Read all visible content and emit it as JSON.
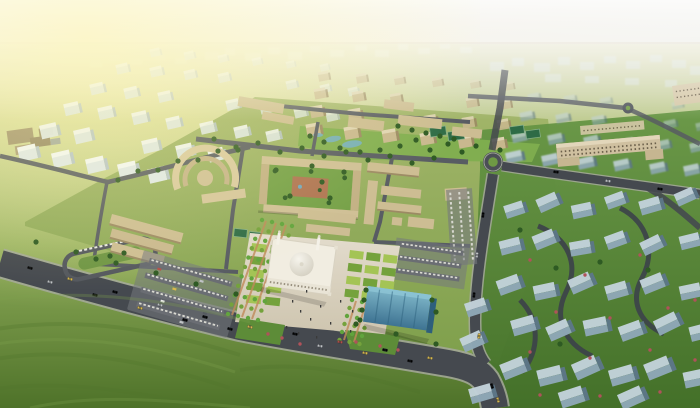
{
  "meta": {
    "description": "Sunlit aerial rendering of a master-planned district: tan low-rise campus around a central domed mosque and plaza, white apartment blocks fading into haze upper-left, beige residential towers top-center with a park, blue-gray housing clusters to the right, tree-lined boulevards with cars, open grassland in the foreground."
  },
  "palette": {
    "sky_top": "#d8d1bd",
    "sky_mid": "#ece6d6",
    "sky_low": "#f6f3e8",
    "sky_right": "#e0e8ec",
    "horizon": "#d9d2bd",
    "sun_glow": "#fbf3ac",
    "ground_haze": "#e3e2c8",
    "grass_light": "#becb90",
    "grass_mid": "#8fac5a",
    "grass_deep": "#4e7229",
    "road": "#45494f",
    "road_edge": "#a6a99c",
    "street": "#585c63",
    "inner_road": "#3c424a",
    "campus_green_1": "#a2b569",
    "campus_green_2": "#7fa04c",
    "tan_face": "#c9b88f",
    "tan_top": "#e0d5b4",
    "tan_shade": "#9c8a64",
    "beige_school": "#cfc0a0",
    "white_face": "#dfe8eb",
    "white_top": "#f3f7f8",
    "white_shade": "#b6c4cb",
    "blue_top": "#c2d2da",
    "blue_face": "#8fa8b7",
    "blue_shade": "#5d7788",
    "lawn_a": "#a4c455",
    "lawn_b": "#74a23c",
    "tree": "#2e5a23",
    "palm": "#61a43d",
    "bush_red": "#b0525a",
    "plaza_light": "#e3dccd",
    "plaza_dark": "#cec5af",
    "terracotta": "#ae7352",
    "walkway": "#c08a5a",
    "mosque_wall": "#f1ede1",
    "mosque_dome_hi": "#f6f4ec",
    "mosque_dome_lo": "#cfcabb",
    "glass_hi": "#7fb7c9",
    "glass_lo": "#3e7392",
    "pond": "#74aec2",
    "court_green": "#2e6b46",
    "parking": "#75787d",
    "car_white": "#ececе6",
    "car_yellow": "#d9b94c",
    "car_silver": "#c0c3c6",
    "car_red": "#b34f48",
    "car_dark": "#555a60"
  },
  "districts": {
    "white_blocks": [
      [
        18,
        152,
        1.3,
        1
      ],
      [
        52,
        158,
        1.3,
        1
      ],
      [
        86,
        164,
        1.3,
        1
      ],
      [
        118,
        169,
        1.3,
        1
      ],
      [
        148,
        174,
        1.25,
        1
      ],
      [
        40,
        130,
        1.2,
        0.95
      ],
      [
        74,
        135,
        1.2,
        0.95
      ],
      [
        142,
        145,
        1.15,
        0.95
      ],
      [
        176,
        150,
        1.15,
        0.95
      ],
      [
        208,
        154,
        1.1,
        0.95
      ],
      [
        64,
        108,
        1.05,
        0.9
      ],
      [
        98,
        112,
        1.05,
        0.9
      ],
      [
        132,
        117,
        1.05,
        0.9
      ],
      [
        166,
        122,
        1,
        0.9
      ],
      [
        200,
        127,
        1,
        0.9
      ],
      [
        234,
        131,
        1,
        0.9
      ],
      [
        266,
        135,
        0.95,
        0.88
      ],
      [
        90,
        88,
        0.95,
        0.8
      ],
      [
        124,
        92,
        0.95,
        0.8
      ],
      [
        158,
        96,
        0.9,
        0.8
      ],
      [
        226,
        104,
        0.9,
        0.78
      ],
      [
        260,
        108,
        0.85,
        0.76
      ],
      [
        294,
        112,
        0.85,
        0.75
      ],
      [
        326,
        116,
        0.8,
        0.72
      ],
      [
        116,
        68,
        0.85,
        0.62
      ],
      [
        150,
        71,
        0.85,
        0.62
      ],
      [
        184,
        74,
        0.8,
        0.6
      ],
      [
        218,
        77,
        0.8,
        0.58
      ],
      [
        286,
        84,
        0.75,
        0.55
      ],
      [
        320,
        88,
        0.7,
        0.5
      ],
      [
        348,
        91,
        0.7,
        0.48
      ],
      [
        150,
        52,
        0.7,
        0.45
      ],
      [
        184,
        55,
        0.7,
        0.42
      ],
      [
        218,
        58,
        0.65,
        0.4
      ],
      [
        252,
        61,
        0.65,
        0.38
      ],
      [
        286,
        64,
        0.6,
        0.35
      ],
      [
        320,
        67,
        0.6,
        0.32
      ]
    ],
    "beige_blocks": [
      [
        306,
        128,
        1.15,
        1
      ],
      [
        344,
        131,
        1.15,
        1
      ],
      [
        382,
        134,
        1.15,
        1
      ],
      [
        420,
        137,
        1.1,
        1
      ],
      [
        458,
        140,
        1.1,
        1
      ],
      [
        492,
        142,
        1.05,
        0.98
      ],
      [
        310,
        110,
        1.05,
        0.95
      ],
      [
        348,
        113,
        1.05,
        0.95
      ],
      [
        424,
        119,
        1,
        0.92
      ],
      [
        462,
        121,
        1,
        0.9
      ],
      [
        497,
        123,
        0.95,
        0.88
      ],
      [
        314,
        92,
        0.95,
        0.85
      ],
      [
        352,
        95,
        0.95,
        0.85
      ],
      [
        390,
        97,
        0.9,
        0.82
      ],
      [
        466,
        101,
        0.9,
        0.8
      ],
      [
        500,
        103,
        0.85,
        0.78
      ],
      [
        318,
        75,
        0.85,
        0.68
      ],
      [
        356,
        77,
        0.85,
        0.66
      ],
      [
        394,
        79,
        0.8,
        0.62
      ],
      [
        432,
        81,
        0.8,
        0.6
      ],
      [
        470,
        83,
        0.75,
        0.55
      ],
      [
        504,
        85,
        0.75,
        0.5
      ]
    ],
    "hazy_blue_blocks": [
      [
        506,
        158,
        1,
        0.92
      ],
      [
        542,
        161,
        1,
        0.9
      ],
      [
        578,
        164,
        1,
        0.9
      ],
      [
        614,
        166,
        0.95,
        0.88
      ],
      [
        650,
        169,
        0.95,
        0.85
      ],
      [
        684,
        171,
        0.95,
        0.85
      ],
      [
        512,
        138,
        0.9,
        0.75
      ],
      [
        548,
        140,
        0.9,
        0.75
      ],
      [
        584,
        142,
        0.9,
        0.72
      ],
      [
        620,
        144,
        0.85,
        0.7
      ],
      [
        656,
        146,
        0.85,
        0.7
      ],
      [
        690,
        148,
        0.85,
        0.68
      ],
      [
        520,
        117,
        0.8,
        0.6
      ],
      [
        556,
        119,
        0.8,
        0.58
      ],
      [
        592,
        121,
        0.78,
        0.55
      ],
      [
        664,
        125,
        0.75,
        0.52
      ],
      [
        696,
        127,
        0.72,
        0.5
      ],
      [
        528,
        98,
        0.7,
        0.42
      ],
      [
        564,
        100,
        0.7,
        0.4
      ],
      [
        600,
        102,
        0.68,
        0.38
      ],
      [
        672,
        106,
        0.65,
        0.35
      ]
    ],
    "blue_blocks": [
      [
        505,
        212,
        1.2,
        -18
      ],
      [
        538,
        206,
        1.3,
        -24
      ],
      [
        572,
        212,
        1.25,
        -12
      ],
      [
        606,
        203,
        1.2,
        -20
      ],
      [
        640,
        208,
        1.3,
        -16
      ],
      [
        676,
        200,
        1.2,
        -24
      ],
      [
        500,
        248,
        1.3,
        -14
      ],
      [
        534,
        243,
        1.35,
        -22
      ],
      [
        570,
        249,
        1.3,
        -10
      ],
      [
        606,
        243,
        1.25,
        -20
      ],
      [
        642,
        249,
        1.3,
        -26
      ],
      [
        680,
        243,
        1.25,
        -14
      ],
      [
        498,
        288,
        1.4,
        -20
      ],
      [
        534,
        293,
        1.35,
        -12
      ],
      [
        570,
        287,
        1.4,
        -24
      ],
      [
        606,
        293,
        1.35,
        -16
      ],
      [
        642,
        287,
        1.4,
        -22
      ],
      [
        680,
        293,
        1.3,
        -12
      ],
      [
        512,
        328,
        1.45,
        -16
      ],
      [
        548,
        334,
        1.4,
        -24
      ],
      [
        584,
        328,
        1.45,
        -12
      ],
      [
        620,
        334,
        1.4,
        -20
      ],
      [
        656,
        328,
        1.45,
        -26
      ],
      [
        690,
        334,
        1.35,
        -14
      ],
      [
        502,
        372,
        1.5,
        -22
      ],
      [
        538,
        378,
        1.5,
        -14
      ],
      [
        574,
        372,
        1.55,
        -24
      ],
      [
        610,
        378,
        1.5,
        -16
      ],
      [
        646,
        372,
        1.55,
        -22
      ],
      [
        684,
        380,
        1.45,
        -12
      ],
      [
        560,
        400,
        1.5,
        -18
      ],
      [
        620,
        402,
        1.5,
        -24
      ],
      [
        466,
        310,
        1.3,
        -18
      ],
      [
        462,
        345,
        1.35,
        -24
      ],
      [
        470,
        396,
        1.4,
        -16
      ]
    ]
  },
  "distant_city": {
    "center": [
      [
        205,
        52,
        14,
        8
      ],
      [
        225,
        48,
        10,
        7
      ],
      [
        245,
        53,
        16,
        8
      ],
      [
        268,
        47,
        12,
        7
      ],
      [
        288,
        52,
        14,
        8
      ],
      [
        310,
        46,
        10,
        6
      ],
      [
        330,
        50,
        14,
        7
      ],
      [
        355,
        45,
        12,
        6
      ],
      [
        375,
        50,
        14,
        7
      ],
      [
        398,
        44,
        10,
        6
      ],
      [
        418,
        48,
        12,
        6
      ],
      [
        440,
        44,
        10,
        5
      ],
      [
        460,
        47,
        12,
        6
      ]
    ],
    "right": [
      [
        490,
        62,
        14,
        9
      ],
      [
        512,
        58,
        12,
        8
      ],
      [
        534,
        63,
        16,
        9
      ],
      [
        558,
        57,
        12,
        8
      ],
      [
        580,
        62,
        14,
        8
      ],
      [
        604,
        56,
        12,
        7
      ],
      [
        626,
        61,
        14,
        8
      ],
      [
        650,
        55,
        12,
        7
      ],
      [
        672,
        60,
        14,
        8
      ],
      [
        690,
        66,
        14,
        9
      ],
      [
        545,
        74,
        16,
        8
      ],
      [
        585,
        76,
        14,
        7
      ],
      [
        625,
        78,
        14,
        7
      ],
      [
        665,
        80,
        12,
        7
      ]
    ],
    "left": [
      [
        90,
        60,
        12,
        7
      ],
      [
        110,
        55,
        10,
        6
      ],
      [
        130,
        59,
        12,
        6
      ],
      [
        155,
        54,
        10,
        6
      ],
      [
        175,
        58,
        12,
        6
      ]
    ]
  },
  "greenery": {
    "trees": [
      [
        214,
        139
      ],
      [
        236,
        147
      ],
      [
        258,
        143
      ],
      [
        280,
        152
      ],
      [
        302,
        148
      ],
      [
        324,
        156
      ],
      [
        346,
        152
      ],
      [
        368,
        160
      ],
      [
        390,
        156
      ],
      [
        412,
        163
      ],
      [
        434,
        158
      ],
      [
        118,
        180
      ],
      [
        138,
        171
      ],
      [
        158,
        170
      ],
      [
        178,
        161
      ],
      [
        198,
        160
      ],
      [
        218,
        151
      ],
      [
        238,
        150
      ],
      [
        36,
        242
      ],
      [
        76,
        252
      ],
      [
        116,
        263
      ],
      [
        156,
        273
      ],
      [
        196,
        284
      ],
      [
        236,
        294
      ],
      [
        356,
        324
      ],
      [
        396,
        334
      ],
      [
        436,
        344
      ],
      [
        276,
        170
      ],
      [
        290,
        196
      ],
      [
        312,
        166
      ],
      [
        330,
        198
      ],
      [
        344,
        172
      ],
      [
        322,
        182
      ],
      [
        310,
        136
      ],
      [
        324,
        142
      ],
      [
        340,
        148
      ],
      [
        360,
        152
      ],
      [
        380,
        150
      ],
      [
        400,
        146
      ],
      [
        416,
        140
      ],
      [
        430,
        150
      ],
      [
        448,
        144
      ],
      [
        462,
        152
      ],
      [
        476,
        146
      ],
      [
        500,
        150
      ],
      [
        398,
        126
      ],
      [
        412,
        130
      ],
      [
        426,
        133
      ],
      [
        440,
        136
      ],
      [
        454,
        139
      ],
      [
        96,
        259
      ],
      [
        110,
        256
      ],
      [
        124,
        253
      ],
      [
        520,
        230
      ],
      [
        556,
        268
      ],
      [
        600,
        262
      ],
      [
        648,
        270
      ],
      [
        560,
        344
      ],
      [
        366,
        290
      ],
      [
        364,
        300
      ],
      [
        362,
        310
      ],
      [
        360,
        320
      ],
      [
        432,
        300
      ],
      [
        436,
        312
      ]
    ],
    "palm_rows": [
      {
        "x": 262,
        "y": 220,
        "dx": -3.4,
        "dy": 9.4,
        "n": 11
      },
      {
        "x": 272,
        "y": 222,
        "dx": -3.4,
        "dy": 9.4,
        "n": 11
      },
      {
        "x": 282,
        "y": 224,
        "dx": -3.4,
        "dy": 9.4,
        "n": 11
      },
      {
        "x": 292,
        "y": 226,
        "dx": -3.4,
        "dy": 9.4,
        "n": 11
      },
      {
        "x": 352,
        "y": 300,
        "dx": -2.5,
        "dy": 8,
        "n": 6
      },
      {
        "x": 362,
        "y": 302,
        "dx": -2.5,
        "dy": 8,
        "n": 6
      },
      {
        "x": 372,
        "y": 304,
        "dx": -2.5,
        "dy": 8,
        "n": 6
      }
    ],
    "bushes": [
      [
        530,
        260
      ],
      [
        585,
        275
      ],
      [
        640,
        255
      ],
      [
        556,
        312
      ],
      [
        610,
        318
      ],
      [
        668,
        308
      ],
      [
        530,
        352
      ],
      [
        590,
        358
      ],
      [
        650,
        350
      ],
      [
        540,
        395
      ],
      [
        600,
        396
      ],
      [
        660,
        392
      ],
      [
        695,
        300
      ],
      [
        695,
        360
      ],
      [
        268,
        334
      ],
      [
        282,
        338
      ],
      [
        300,
        344
      ],
      [
        356,
        342
      ],
      [
        380,
        346
      ],
      [
        398,
        350
      ]
    ]
  },
  "plaza": {
    "checkers": [
      {
        "x": 252,
        "y": 243,
        "rot": 6,
        "rows": 5,
        "cols": 2,
        "w": 15,
        "h": 8,
        "gx": 19,
        "gy": 13
      },
      {
        "x": 350,
        "y": 250,
        "rot": 7,
        "rows": 4,
        "cols": 3,
        "w": 14,
        "h": 8,
        "gx": 17,
        "gy": 13
      }
    ]
  },
  "vehicles": {
    "color_map": {
      "w": "car_white",
      "y": "car_yellow",
      "s": "car_silver",
      "r": "car_red",
      "d": "car_dark"
    },
    "cars": [
      [
        30,
        268,
        15,
        "w"
      ],
      [
        70,
        279,
        15,
        "y"
      ],
      [
        115,
        292,
        15,
        "w"
      ],
      [
        160,
        305,
        15,
        "s"
      ],
      [
        205,
        317,
        15,
        "w"
      ],
      [
        250,
        327,
        14,
        "y"
      ],
      [
        295,
        334,
        12,
        "w"
      ],
      [
        340,
        342,
        11,
        "r"
      ],
      [
        385,
        350,
        11,
        "w"
      ],
      [
        430,
        358,
        11,
        "y"
      ],
      [
        50,
        282,
        15,
        "s"
      ],
      [
        95,
        295,
        15,
        "w"
      ],
      [
        140,
        308,
        15,
        "y"
      ],
      [
        185,
        320,
        15,
        "w"
      ],
      [
        230,
        329,
        14,
        "w"
      ],
      [
        320,
        346,
        11,
        "s"
      ],
      [
        365,
        353,
        11,
        "y"
      ],
      [
        410,
        361,
        11,
        "w"
      ],
      [
        492,
        386,
        72,
        "w"
      ],
      [
        498,
        400,
        75,
        "y"
      ],
      [
        483,
        215,
        -84,
        "w"
      ],
      [
        477,
        255,
        -84,
        "s"
      ],
      [
        474,
        295,
        -84,
        "w"
      ],
      [
        479,
        336,
        -80,
        "y"
      ],
      [
        556,
        172,
        8,
        "w"
      ],
      [
        608,
        181,
        8,
        "s"
      ],
      [
        660,
        189,
        8,
        "w"
      ]
    ]
  },
  "people": [
    [
      292,
      300
    ],
    [
      300,
      310
    ],
    [
      310,
      318
    ],
    [
      320,
      305
    ],
    [
      330,
      322
    ],
    [
      286,
      326
    ],
    [
      340,
      300
    ],
    [
      350,
      330
    ],
    [
      316,
      336
    ],
    [
      306,
      290
    ],
    [
      352,
      310
    ],
    [
      298,
      332
    ]
  ]
}
